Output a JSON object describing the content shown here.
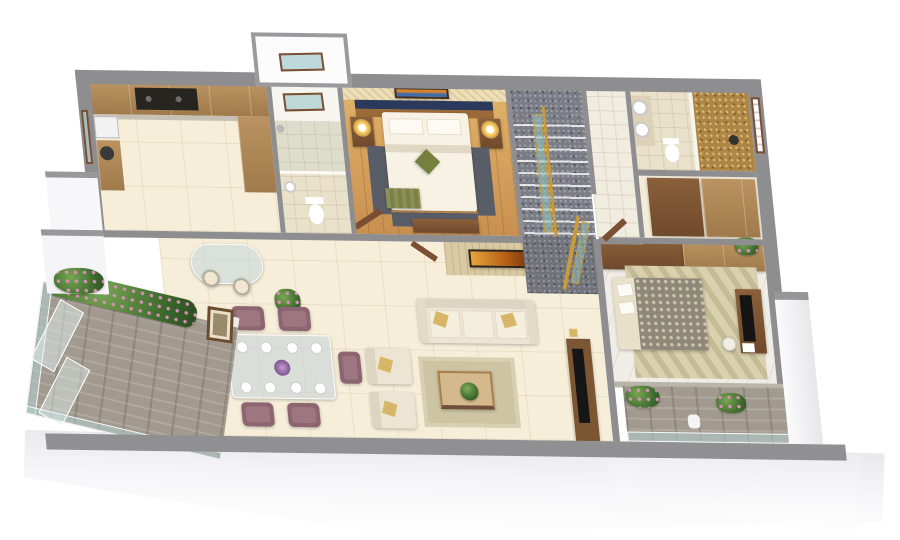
{
  "meta": {
    "title": "3D isometric apartment floor plan render",
    "view": "top-down cutaway"
  },
  "palette": {
    "background": "#ffffff",
    "outer_wall": "#8e8e91",
    "foundation": "#f0f0f3",
    "floor_tile": "#f6eed9",
    "wood_floor": "#d9a75f",
    "cabinet_wood": "#ab845a",
    "dark_cooktop": "#26251f",
    "stair_gray": "#7b7d86",
    "railing_gold": "#c79a3b",
    "glass_teal": "#a8cdc9",
    "mosaic_gold": "#ad8544",
    "sofa_cream": "#ece5d3",
    "cushion_gold": "#d7b667",
    "chair_mauve": "#8c6571",
    "rug_beige": "#cdc4a3",
    "bedspread_gray": "#8e8878",
    "plant_green": "#4e7d3a",
    "flower_pink": "#d98fb5",
    "navy_accent": "#2b3a5c",
    "art_blue": "#3f6ea8",
    "art_amber": "#c2711f"
  },
  "rooms": {
    "kitchen": {
      "name": "Kitchen",
      "furniture": [
        "upper-cabinets",
        "cooktop",
        "side-counter",
        "appliance",
        "waste-bin"
      ]
    },
    "common_bathroom": {
      "name": "Common Bathroom",
      "furniture": [
        "shower",
        "toilet",
        "washbasin",
        "window"
      ]
    },
    "master_bedroom": {
      "name": "Master Bedroom",
      "furniture": [
        "double-bed",
        "pillows",
        "olive-throw-cushion",
        "bench",
        "bedside-tables",
        "lamps",
        "seascape-art",
        "dresser",
        "carpet-runners"
      ]
    },
    "staircase": {
      "name": "Staircase",
      "furniture": [
        "carpeted-steps",
        "gold-railing",
        "glass-balustrade",
        "landing"
      ]
    },
    "foyer": {
      "name": "Foyer",
      "furniture": [
        "entry-door"
      ]
    },
    "master_bathroom": {
      "name": "Master Bathroom",
      "furniture": [
        "twin-washbasins",
        "toilet",
        "gold-mosaic-shower",
        "louvre-window"
      ]
    },
    "dressing": {
      "name": "Dressing Area",
      "furniture": [
        "wardrobes"
      ]
    },
    "dining": {
      "name": "Dining Area",
      "furniture": [
        "glass-dining-table",
        "six-mauve-chairs",
        "eight-plates",
        "flower-centerpiece",
        "breakfast-counter",
        "bar-stools",
        "aloe-plant",
        "wall-frame"
      ]
    },
    "living": {
      "name": "Living Room",
      "furniture": [
        "three-seat-sofa",
        "two-armchairs",
        "gold-cushions",
        "area-rug",
        "coffee-table",
        "house-plant",
        "stone-feature-wall",
        "amber-artwork",
        "tv-console",
        "television"
      ]
    },
    "bedroom2": {
      "name": "Bedroom 2",
      "furniture": [
        "double-bed",
        "patterned-duvet",
        "leaf-pattern-rug",
        "study-desk",
        "tv-panel",
        "stool",
        "wardrobe-band",
        "flower-vase"
      ]
    },
    "balcony_left": {
      "name": "Balcony",
      "furniture": [
        "stone-tiles",
        "glass-railing",
        "leaning-glass-panels",
        "planters"
      ]
    },
    "balcony_right": {
      "name": "Bedroom Balcony",
      "furniture": [
        "stone-tiles",
        "glass-railing",
        "flower-planters",
        "pot"
      ]
    }
  }
}
